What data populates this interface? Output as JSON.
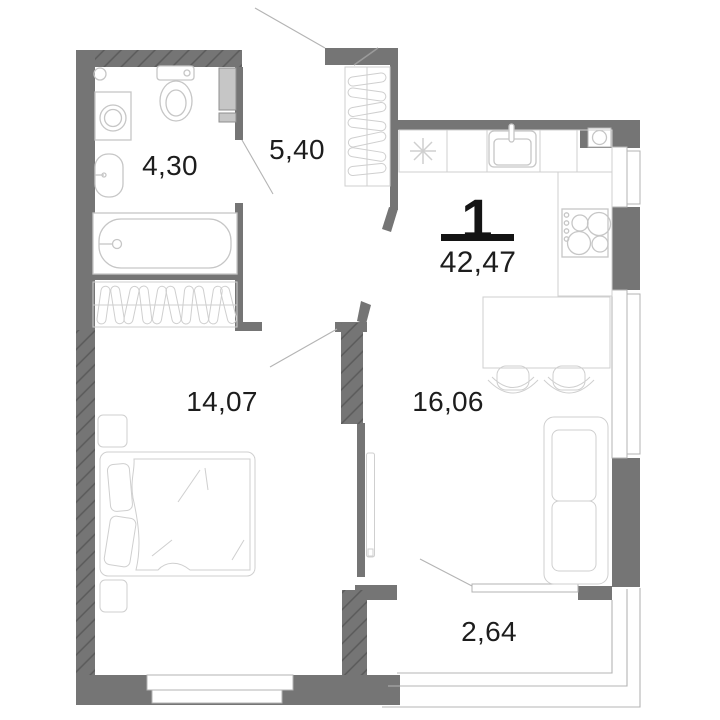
{
  "apartment": {
    "rooms_count_label": "1",
    "total_area_m2": "42,47"
  },
  "rooms": [
    {
      "name": "bathroom",
      "area": "4,30"
    },
    {
      "name": "hallway",
      "area": "5,40"
    },
    {
      "name": "bedroom",
      "area": "14,07"
    },
    {
      "name": "kitchen-living",
      "area": "16,06"
    },
    {
      "name": "balcony",
      "area": "2,64"
    }
  ],
  "colors": {
    "wall": "#757575",
    "wall_hatch": "#5a5a5a",
    "furniture_outline": "#c6c6c6",
    "window_outline": "#b3b3b3",
    "label_text": "#1d1d1d",
    "area_divider_bar": "#141414",
    "duct_fill": "#c6c6c6"
  },
  "icons": [
    "bathtub-icon",
    "toilet-icon",
    "washbasin-icon",
    "washing-machine-icon",
    "spotlight-icon",
    "wardrobe-icon",
    "bed-icon",
    "nightstand-icon",
    "tv-icon",
    "sofa-icon",
    "dining-table-icon",
    "stool-icon",
    "kitchen-sink-icon",
    "stove-icon",
    "asterisk-marker-icon",
    "ventilation-icon",
    "window-icon",
    "door-leaf-icon",
    "balcony-glazing-icon",
    "duct-shaft-icon"
  ]
}
